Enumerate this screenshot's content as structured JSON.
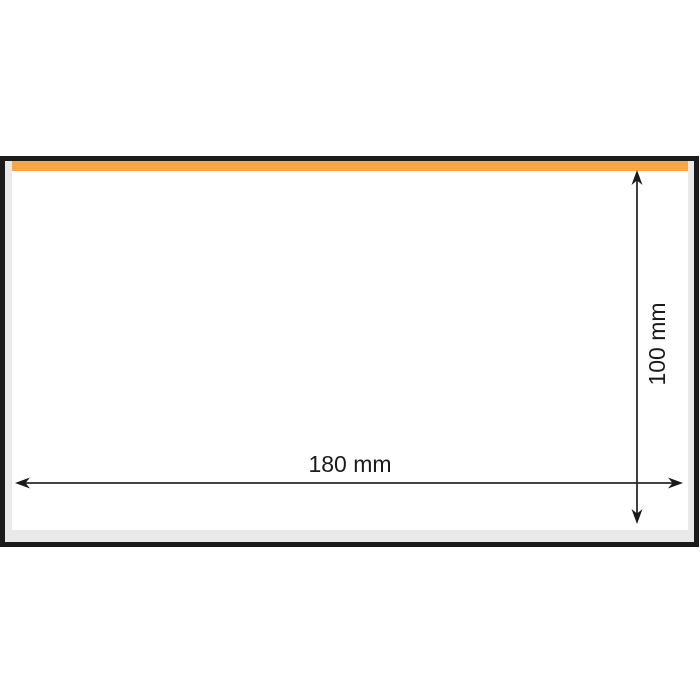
{
  "diagram": {
    "description": "Rectangular panel with an orange strip along the inside of its top edge, dimensioned 180 mm wide by 100 mm high",
    "labels": {
      "width": "180 mm",
      "height": "100 mm"
    },
    "values": {
      "width_mm": 180,
      "height_mm": 100
    },
    "colors": {
      "strip_orange": "#F5A74A",
      "panel_border": "#1B1B1B",
      "panel_inset_gray": "#E9E9E9",
      "panel_face": "#FFFFFF",
      "dimension_line": "#2A2A2A",
      "background": "#FFFFFF"
    }
  }
}
